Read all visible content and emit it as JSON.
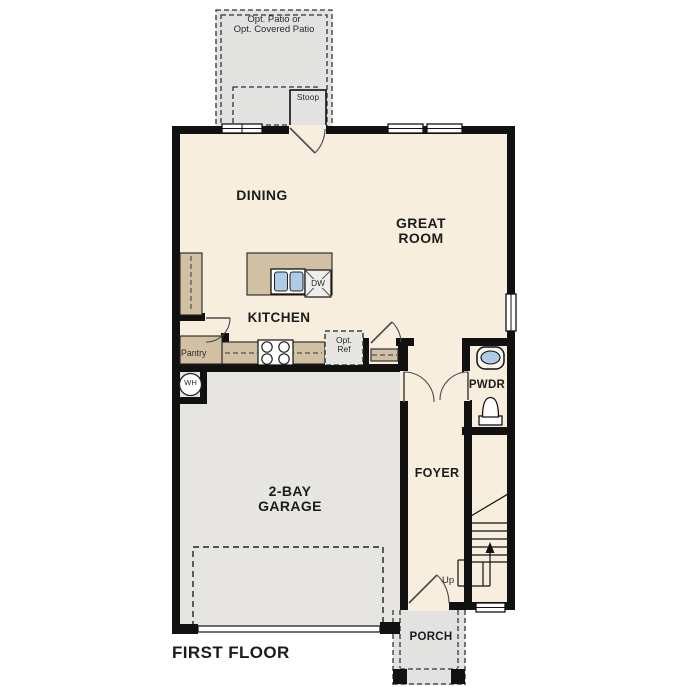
{
  "plan": {
    "floor_title": "FIRST FLOOR",
    "rooms": {
      "dining": {
        "label": "DINING"
      },
      "great_room": {
        "line1": "GREAT",
        "line2": "ROOM"
      },
      "kitchen": {
        "label": "KITCHEN"
      },
      "garage": {
        "line1": "2-BAY",
        "line2": "GARAGE"
      },
      "foyer": {
        "label": "FOYER"
      },
      "powder": {
        "label": "PWDR"
      },
      "porch": {
        "label": "PORCH"
      },
      "pantry": {
        "label": "Pantry"
      },
      "stoop": {
        "label": "Stoop"
      },
      "patio": {
        "line1": "Opt. Patio or",
        "line2": "Opt. Covered Patio"
      }
    },
    "fixtures": {
      "water_heater": "WH",
      "dishwasher": "DW",
      "opt_fridge_line1": "Opt.",
      "opt_fridge_line2": "Ref",
      "stairs_up": "Up"
    },
    "colors": {
      "floor": "#f7eede",
      "exterior_concrete": "#e2e2e0",
      "garage_floor": "#e6e5e2",
      "counter": "#d2c0a4",
      "appliance": "#f0eeea",
      "opt_ref_fill": "#e7e6e2",
      "sink": "#aecbe8",
      "wall": "#111111",
      "window": "#ffffff"
    }
  }
}
